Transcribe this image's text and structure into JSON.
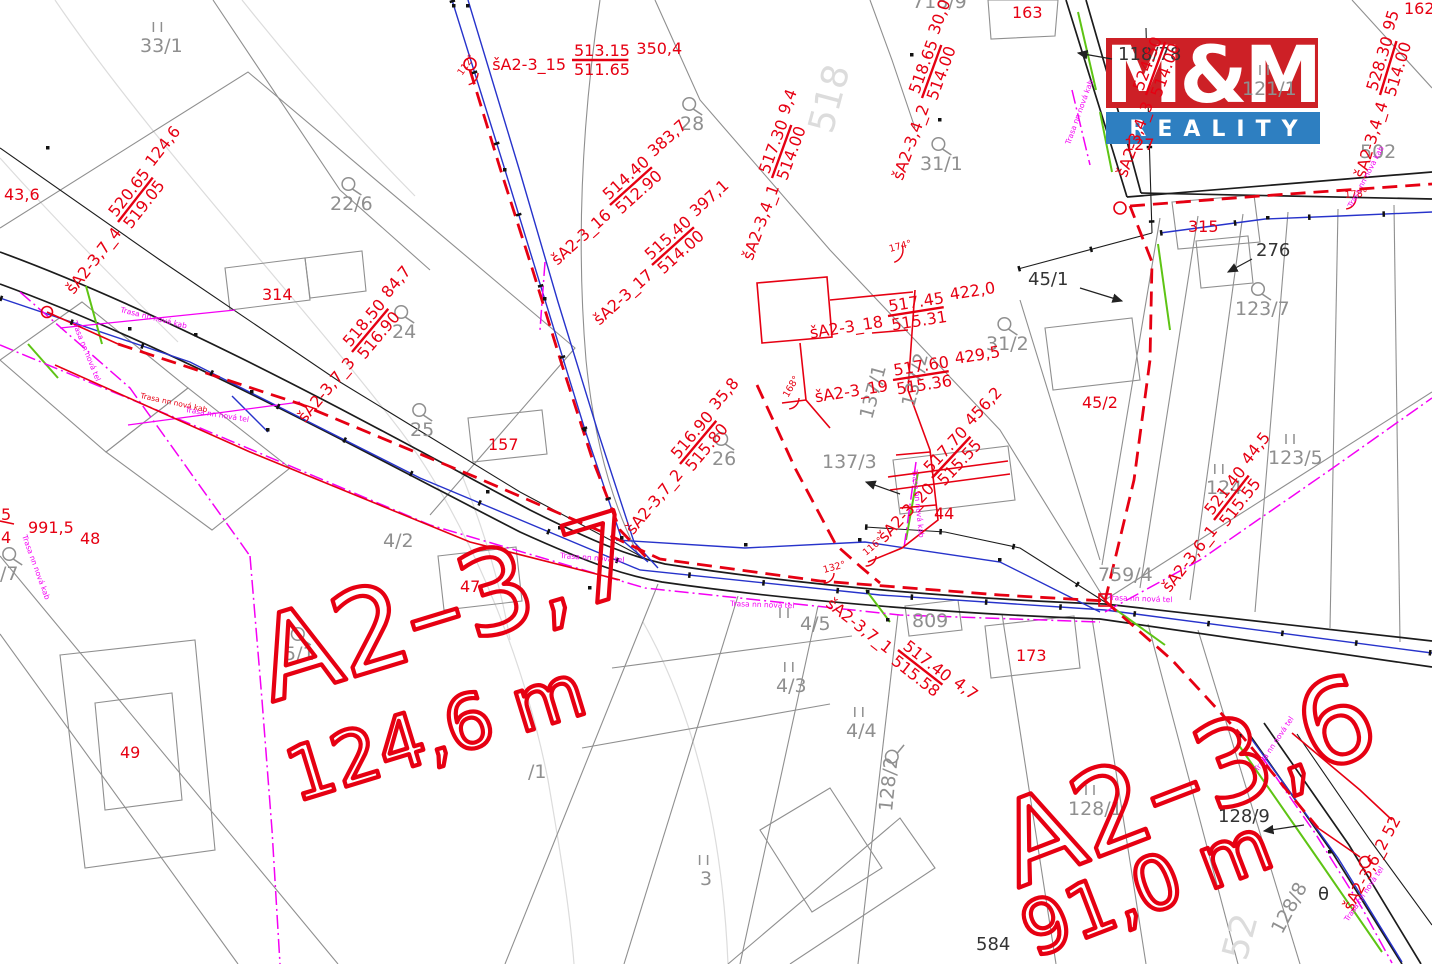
{
  "colors": {
    "route_red": "#e60012",
    "parcel_gray": "#8f8f8f",
    "contour_gray": "#dcdcdc",
    "utility_blue": "#2733cb",
    "gas_green": "#5ec414",
    "telecom_magenta": "#f400f4",
    "logo_red": "#cd2026",
    "logo_blue": "#2e7fc1",
    "line_black": "#1c1c1c"
  },
  "logo": {
    "mm": "M&M",
    "reality": "REALITY"
  },
  "titles": [
    {
      "t": "A2–3,7",
      "x": 272,
      "y": 702,
      "rot": -17,
      "size": 115
    },
    {
      "t": "124,6 m",
      "x": 296,
      "y": 802,
      "rot": -17,
      "size": 74
    },
    {
      "t": "A2–3,6",
      "x": 1018,
      "y": 888,
      "rot": -21,
      "size": 115
    },
    {
      "t": "91,0 m",
      "x": 1034,
      "y": 958,
      "rot": -21,
      "size": 74
    }
  ],
  "shafts": [
    {
      "n": "šA2-3_15",
      "top": "513.15",
      "bot": "511.65",
      "dist": "350,4",
      "x": 572,
      "y": 60,
      "rot": 0
    },
    {
      "n": "šA2-3_16",
      "top": "514.40",
      "bot": "512.90",
      "dist": "383,7",
      "x": 610,
      "y": 205,
      "rot": -42
    },
    {
      "n": "šA2-3_17",
      "top": "515.40",
      "bot": "514.00",
      "dist": "397,1",
      "x": 652,
      "y": 265,
      "rot": -42
    },
    {
      "n": "šA2-3,4_1",
      "top": "517.30",
      "bot": "514.00",
      "dist": "9,4",
      "x": 772,
      "y": 178,
      "rot": -70
    },
    {
      "n": "šA2-3,4_2",
      "top": "518.65",
      "bot": "514.00",
      "dist": "30,0",
      "x": 922,
      "y": 98,
      "rot": -70
    },
    {
      "n": "šA2-3,4_3",
      "top": "524.50",
      "bot": "514.00",
      "dist": "",
      "x": 1146,
      "y": 95,
      "rot": -70
    },
    {
      "n": "šA2-3,4_4",
      "top": "528.30",
      "bot": "514.00",
      "dist": "95",
      "x": 1380,
      "y": 95,
      "rot": -73
    },
    {
      "n": "šA2-3_18",
      "top": "517.45",
      "bot": "515.31",
      "dist": "422,0",
      "x": 888,
      "y": 316,
      "rot": -9
    },
    {
      "n": "šA2-3_19",
      "top": "517.60",
      "bot": "515.36",
      "dist": "429,5",
      "x": 893,
      "y": 380,
      "rot": -9
    },
    {
      "n": "šA2-3_20",
      "top": "517.70",
      "bot": "515.55",
      "dist": "456,2",
      "x": 932,
      "y": 478,
      "rot": -47
    },
    {
      "n": "šA2-3,7_4",
      "top": "520.65",
      "bot": "519.05",
      "dist": "124,6",
      "x": 118,
      "y": 222,
      "rot": -52
    },
    {
      "n": "šA2-3,7_3",
      "top": "518.50",
      "bot": "516.90",
      "dist": "84,7",
      "x": 352,
      "y": 352,
      "rot": -50
    },
    {
      "n": "šA2-3,7_2",
      "top": "516.90",
      "bot": "515.80",
      "dist": "35,8",
      "x": 680,
      "y": 464,
      "rot": -50
    },
    {
      "n": "šA2-3,7_1",
      "top": "517.40",
      "bot": "515.58",
      "dist": "4,7",
      "x": 898,
      "y": 650,
      "rot": 38
    },
    {
      "n": "šA2-3,6_1",
      "top": "521.40",
      "bot": "515.55",
      "dist": "44,5",
      "x": 1214,
      "y": 520,
      "rot": -52
    }
  ],
  "labels": [
    {
      "t": "33/1",
      "x": 140,
      "y": 52,
      "sym": "II"
    },
    {
      "t": "22/6",
      "x": 330,
      "y": 210,
      "sym": "Q"
    },
    {
      "t": "28",
      "x": 680,
      "y": 130,
      "sym": "Q"
    },
    {
      "t": "24",
      "x": 392,
      "y": 338,
      "sym": "Q"
    },
    {
      "t": "25",
      "x": 410,
      "y": 436,
      "sym": "Q"
    },
    {
      "t": "26",
      "x": 712,
      "y": 465,
      "sym": "Q"
    },
    {
      "t": "5/1",
      "x": 284,
      "y": 660,
      "sym": "Q"
    },
    {
      "t": "4/2",
      "x": 383,
      "y": 547
    },
    {
      "t": "4/5",
      "x": 800,
      "y": 630,
      "sym": "II-left"
    },
    {
      "t": "4/3",
      "x": 776,
      "y": 692,
      "sym": "II"
    },
    {
      "t": "4/4",
      "x": 846,
      "y": 737,
      "sym": "II"
    },
    {
      "t": "3",
      "x": 700,
      "y": 885,
      "sym": "II"
    },
    {
      "t": "123/7",
      "x": 1235,
      "y": 315,
      "sym": "Q"
    },
    {
      "t": "123/5",
      "x": 1268,
      "y": 464,
      "sym": "II"
    },
    {
      "t": "124",
      "x": 1206,
      "y": 494,
      "sym": "II"
    },
    {
      "t": "759/4",
      "x": 1098,
      "y": 581
    },
    {
      "t": "31/1",
      "x": 920,
      "y": 170,
      "sym": "Q"
    },
    {
      "t": "31/2",
      "x": 986,
      "y": 350,
      "sym": "Q"
    },
    {
      "t": "137/3",
      "x": 822,
      "y": 468
    },
    {
      "t": "137/1",
      "x": 872,
      "y": 420,
      "rot": -75
    },
    {
      "t": "137/2",
      "x": 914,
      "y": 408,
      "rot": -75
    },
    {
      "t": "128/2",
      "x": 892,
      "y": 812,
      "rot": -84,
      "sym": "Q-end"
    },
    {
      "t": "128/8",
      "x": 1282,
      "y": 935,
      "rot": -62
    },
    {
      "t": "128/1",
      "x": 1068,
      "y": 815,
      "sym": "II"
    },
    {
      "t": "128/9",
      "x": 1218,
      "y": 822,
      "cls": "k"
    },
    {
      "t": "502",
      "x": 1360,
      "y": 158
    },
    {
      "t": "718/9",
      "x": 912,
      "y": 8
    },
    {
      "t": "121/1",
      "x": 1242,
      "y": 95,
      "sym": "II"
    },
    {
      "t": "/1",
      "x": 528,
      "y": 778
    },
    {
      "t": "/7",
      "x": 0,
      "y": 580,
      "sym": "Q"
    },
    {
      "t": "809",
      "x": 912,
      "y": 627
    },
    {
      "t": "584",
      "x": 976,
      "y": 950,
      "cls": "k",
      "size": 13
    },
    {
      "t": "518",
      "x": 832,
      "y": 135,
      "rot": -75,
      "cls": "f"
    },
    {
      "t": "52",
      "x": 1246,
      "y": 962,
      "rot": -75,
      "cls": "f"
    },
    {
      "t": "43,6",
      "x": 4,
      "y": 200,
      "cls": "r"
    },
    {
      "t": "991,5",
      "x": 28,
      "y": 533,
      "cls": "r"
    },
    {
      "t": "48",
      "x": 80,
      "y": 544,
      "cls": "r"
    },
    {
      "t": "49",
      "x": 120,
      "y": 758,
      "cls": "r"
    },
    {
      "t": "314",
      "x": 262,
      "y": 300,
      "cls": "r"
    },
    {
      "t": "157",
      "x": 488,
      "y": 450,
      "cls": "r"
    },
    {
      "t": "47",
      "x": 460,
      "y": 592,
      "cls": "r"
    },
    {
      "t": "44",
      "x": 934,
      "y": 519,
      "cls": "r"
    },
    {
      "t": "45/2",
      "x": 1082,
      "y": 408,
      "cls": "r"
    },
    {
      "t": "163",
      "x": 1012,
      "y": 18,
      "cls": "r"
    },
    {
      "t": "315",
      "x": 1188,
      "y": 232,
      "cls": "r"
    },
    {
      "t": "173",
      "x": 1016,
      "y": 661,
      "cls": "r"
    },
    {
      "t": "162",
      "x": 1404,
      "y": 14,
      "cls": "r"
    },
    {
      "t": "127",
      "x": 1124,
      "y": 150,
      "cls": "r"
    },
    {
      "t": "276",
      "x": 1256,
      "y": 256,
      "cls": "k"
    },
    {
      "t": "45/1",
      "x": 1028,
      "y": 285,
      "cls": "k"
    },
    {
      "t": "118/78",
      "x": 1118,
      "y": 60,
      "cls": "k"
    },
    {
      "t": "θ",
      "x": 1318,
      "y": 900,
      "cls": "k",
      "size": 26
    },
    {
      "t": "5",
      "x": 1,
      "y": 520,
      "cls": "r"
    },
    {
      "t": "4",
      "x": 1,
      "y": 543,
      "cls": "r"
    },
    {
      "t": "šA2-3,6_2 52",
      "x": 1352,
      "y": 912,
      "rot": -62,
      "cls": "r"
    }
  ],
  "trasa": [
    {
      "t": "Trasa nn nová kab",
      "x": 120,
      "y": 312,
      "rot": 14
    },
    {
      "t": "Trasa nn nová tel",
      "x": 72,
      "y": 322,
      "rot": 68
    },
    {
      "t": "Trasa nn nová tel",
      "x": 185,
      "y": 412,
      "rot": 9
    },
    {
      "t": "Trasa nn nová kab",
      "x": 140,
      "y": 398,
      "rot": 12,
      "c": "r"
    },
    {
      "t": "Trasa nn nová kab",
      "x": 22,
      "y": 536,
      "rot": 70
    },
    {
      "t": "Trasa nn nová tel",
      "x": 560,
      "y": 558,
      "rot": 4
    },
    {
      "t": "Trasa nn nová tel",
      "x": 730,
      "y": 606,
      "rot": 2
    },
    {
      "t": "Trasa nn nová kab",
      "x": 912,
      "y": 470,
      "rot": 84
    },
    {
      "t": "Trasa nn nová tel",
      "x": 1108,
      "y": 600,
      "rot": 2
    },
    {
      "t": "Trasa nn nová kab",
      "x": 1070,
      "y": 145,
      "rot": -70
    },
    {
      "t": "Trasa nn nová tel",
      "x": 1258,
      "y": 772,
      "rot": -56
    },
    {
      "t": "Trasa nn nová tel",
      "x": 1348,
      "y": 922,
      "rot": -56
    },
    {
      "t": "Trasa nn nová kab",
      "x": 1352,
      "y": 208,
      "rot": -62
    }
  ],
  "angles": [
    {
      "t": "112°",
      "x": 462,
      "y": 76,
      "rot": -55
    },
    {
      "t": "174°",
      "x": 890,
      "y": 252,
      "rot": -15
    },
    {
      "t": "178°",
      "x": 1345,
      "y": 198,
      "rot": -5
    },
    {
      "t": "168°",
      "x": 788,
      "y": 398,
      "rot": -60
    },
    {
      "t": "132°",
      "x": 824,
      "y": 573,
      "rot": -15
    },
    {
      "t": "116°",
      "x": 866,
      "y": 556,
      "rot": -40
    }
  ],
  "arrows": [
    {
      "x1": 1112,
      "y1": 59,
      "x2": 1078,
      "y2": 53
    },
    {
      "x1": 1080,
      "y1": 288,
      "x2": 1122,
      "y2": 301
    },
    {
      "x1": 1252,
      "y1": 259,
      "x2": 1228,
      "y2": 272
    },
    {
      "x1": 1304,
      "y1": 825,
      "x2": 1264,
      "y2": 831
    },
    {
      "x1": 900,
      "y1": 494,
      "x2": 866,
      "y2": 482
    }
  ]
}
